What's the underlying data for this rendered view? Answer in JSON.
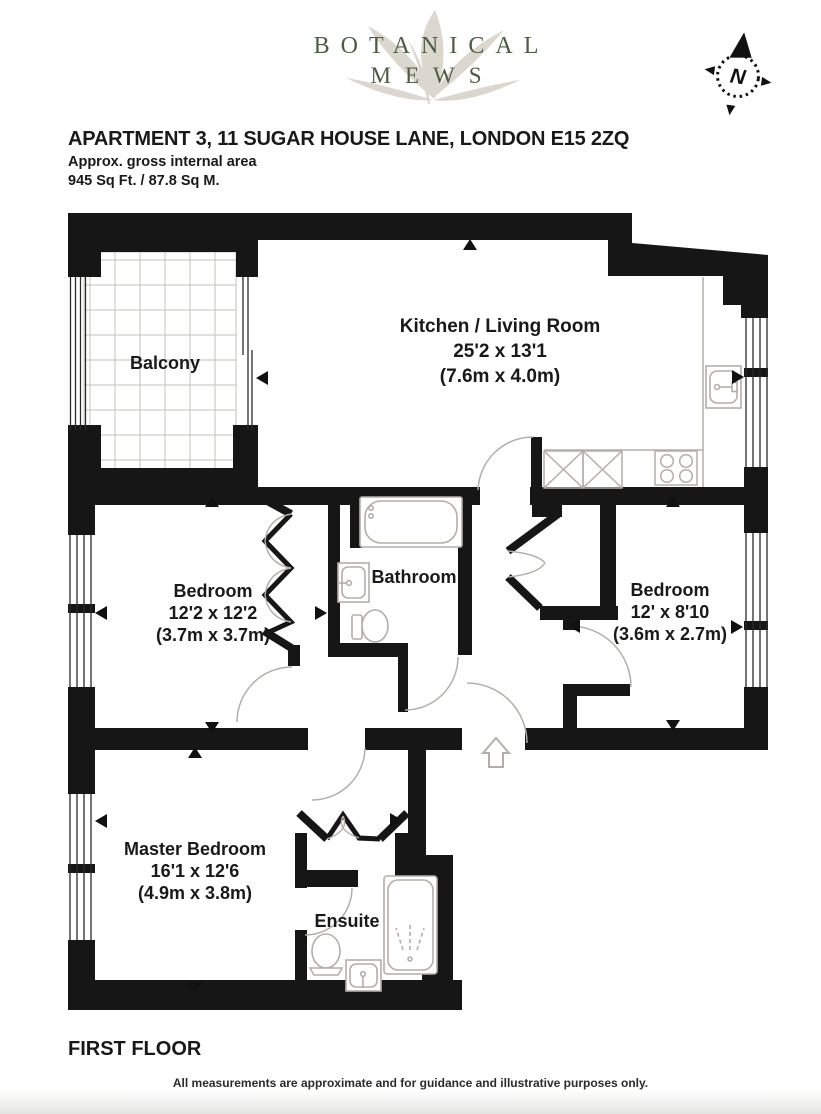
{
  "brand": {
    "line1": "BOTANICAL",
    "line2": "MEWS",
    "compass_letter": "N"
  },
  "header": {
    "title": "APARTMENT 3, 11 SUGAR HOUSE LANE, LONDON E15 2ZQ",
    "area_label": "Approx. gross internal area",
    "area_value": "945 Sq Ft. / 87.8 Sq M."
  },
  "rooms": [
    {
      "name": "Balcony"
    },
    {
      "name": "Kitchen / Living Room",
      "imperial": "25'2 x 13'1",
      "metric": "(7.6m x 4.0m)"
    },
    {
      "name": "Bedroom",
      "imperial": "12'2 x 12'2",
      "metric": "(3.7m x 3.7m)"
    },
    {
      "name": "Bathroom"
    },
    {
      "name": "Bedroom",
      "imperial": "12' x 8'10",
      "metric": "(3.6m x 2.7m)"
    },
    {
      "name": "Master Bedroom",
      "imperial": "16'1 x 12'6",
      "metric": "(4.9m x 3.8m)"
    },
    {
      "name": "Ensuite"
    }
  ],
  "footer": {
    "floor_label": "FIRST FLOOR",
    "disclaimer": "All measurements are approximate and for guidance and illustrative purposes only."
  },
  "colors": {
    "wall": "#161616",
    "fixture": "#b3aea8",
    "grid": "#c6c2bb",
    "logo_green": "#4d5d42",
    "leaf": "#dbd7ce"
  }
}
